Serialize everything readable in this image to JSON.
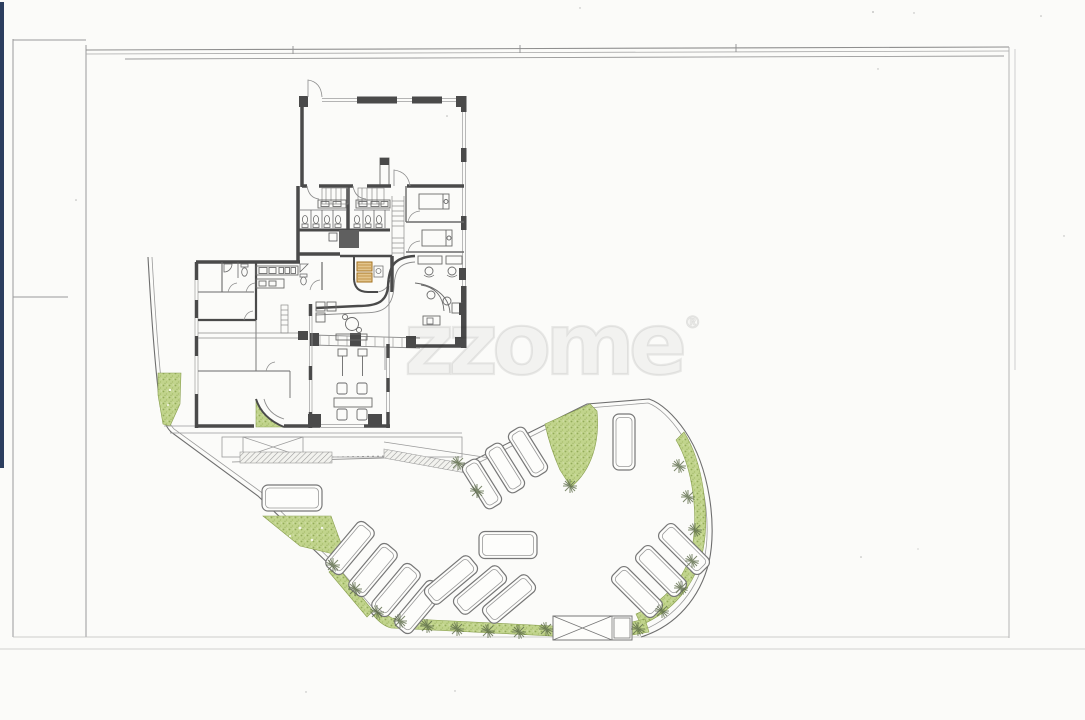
{
  "page": {
    "background": "#fbfbf9",
    "sheet_border_color": "#9a9a9a",
    "scan_strip_color": "#2c3e5f"
  },
  "watermark": {
    "text": "zzome",
    "registered_mark": "®"
  },
  "drawing": {
    "type": "scanned architectural ground-floor and parking site plan",
    "wall_color": "#4a4a4a",
    "line_color": "#8c8c8c",
    "landscape_color": "#c1d48c",
    "accent_furniture_color": "#b5802f",
    "green_area_count": 8,
    "parking": {
      "total_spaces": 16,
      "spaces": [
        {
          "x": 350,
          "y": 548,
          "a": -50,
          "l": 58,
          "w": 21
        },
        {
          "x": 373,
          "y": 570,
          "a": -50,
          "l": 58,
          "w": 21
        },
        {
          "x": 396,
          "y": 590,
          "a": -50,
          "l": 58,
          "w": 21
        },
        {
          "x": 419,
          "y": 607,
          "a": -50,
          "l": 58,
          "w": 21
        },
        {
          "x": 451,
          "y": 580,
          "a": -40,
          "l": 58,
          "w": 21
        },
        {
          "x": 480,
          "y": 590,
          "a": -40,
          "l": 58,
          "w": 21
        },
        {
          "x": 509,
          "y": 599,
          "a": -40,
          "l": 58,
          "w": 21
        },
        {
          "x": 637,
          "y": 592,
          "a": 45,
          "l": 58,
          "w": 21
        },
        {
          "x": 661,
          "y": 571,
          "a": 45,
          "l": 58,
          "w": 21
        },
        {
          "x": 684,
          "y": 549,
          "a": 45,
          "l": 58,
          "w": 21
        },
        {
          "x": 482,
          "y": 484,
          "a": 58,
          "l": 52,
          "w": 19
        },
        {
          "x": 505,
          "y": 468,
          "a": 58,
          "l": 52,
          "w": 19
        },
        {
          "x": 528,
          "y": 452,
          "a": 58,
          "l": 52,
          "w": 19
        },
        {
          "x": 624,
          "y": 442,
          "a": 90,
          "l": 56,
          "w": 22
        },
        {
          "x": 292,
          "y": 498,
          "a": 0,
          "l": 60,
          "w": 26
        },
        {
          "x": 508,
          "y": 545,
          "a": 0,
          "l": 58,
          "w": 27
        }
      ]
    },
    "shrubs": [
      [
        333,
        565
      ],
      [
        355,
        589
      ],
      [
        377,
        612
      ],
      [
        400,
        621
      ],
      [
        427,
        626
      ],
      [
        457,
        629
      ],
      [
        488,
        631
      ],
      [
        519,
        632
      ],
      [
        546,
        629
      ],
      [
        638,
        629
      ],
      [
        662,
        611
      ],
      [
        681,
        588
      ],
      [
        692,
        561
      ],
      [
        695,
        530
      ],
      [
        688,
        497
      ],
      [
        679,
        466
      ],
      [
        570,
        486
      ],
      [
        458,
        463
      ],
      [
        477,
        491
      ]
    ]
  }
}
